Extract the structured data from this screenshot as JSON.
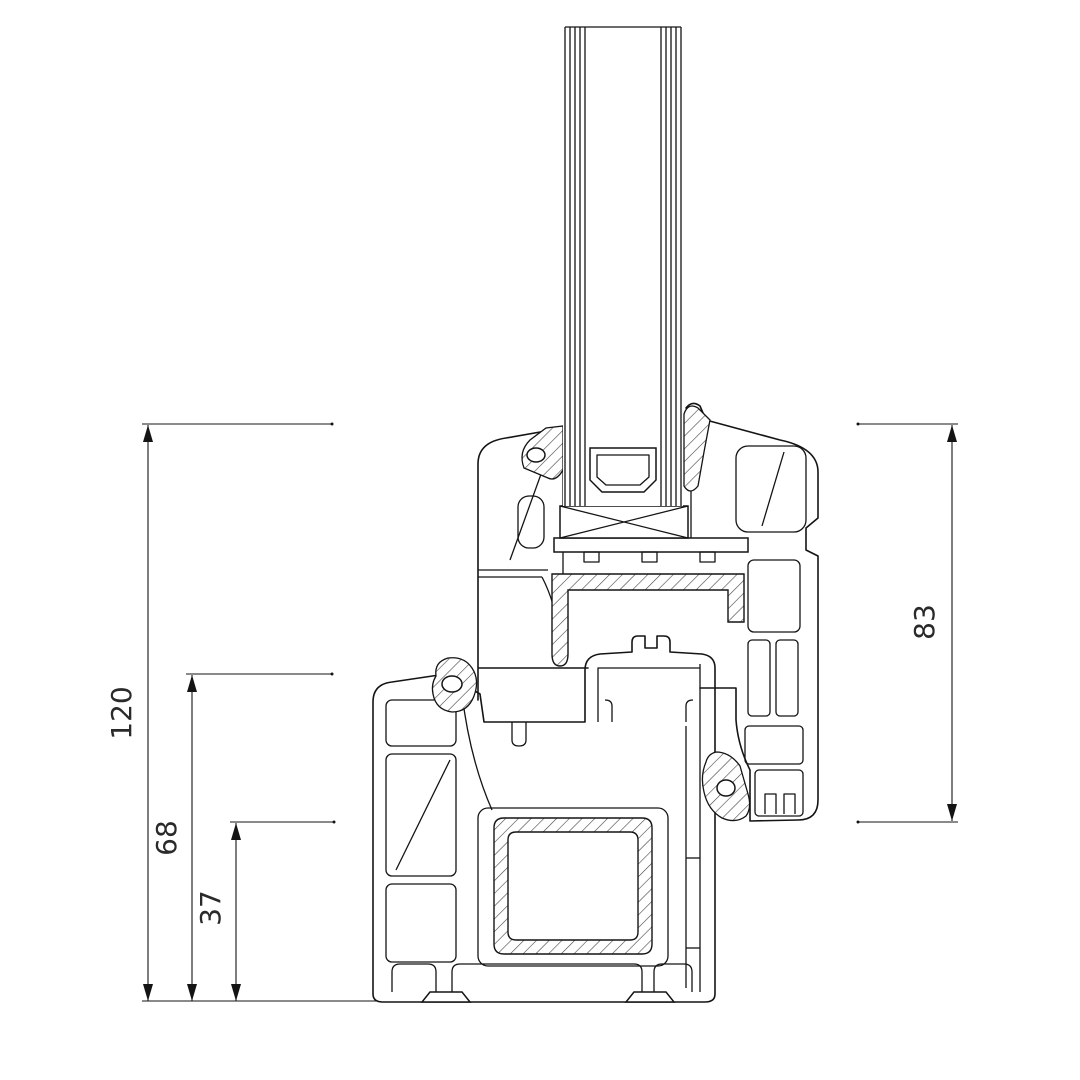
{
  "drawing": {
    "kind": "window profile cross-section technical drawing",
    "background_color": "#ffffff",
    "line_color": "#141414",
    "dimensions": [
      {
        "id": "total-height",
        "value": "120",
        "unit": "mm",
        "side": "left",
        "measures": "overall height of frame plus sash from sash top to frame bottom"
      },
      {
        "id": "frame-height",
        "value": "68",
        "unit": "mm",
        "side": "left",
        "measures": "frame profile height"
      },
      {
        "id": "frame-below-sash",
        "value": "37",
        "unit": "mm",
        "side": "left",
        "measures": "frame height below sash overlap"
      },
      {
        "id": "sash-height",
        "value": "83",
        "unit": "mm",
        "side": "right",
        "measures": "sash profile height including glazing overlap"
      }
    ],
    "parts": {
      "glazing": "double glazing unit with spacer bar",
      "upper_profile": "sash with glazing bead, glazing gaskets and steel reinforcement",
      "lower_profile": "frame with steel reinforcement, seals and screw channels"
    }
  }
}
